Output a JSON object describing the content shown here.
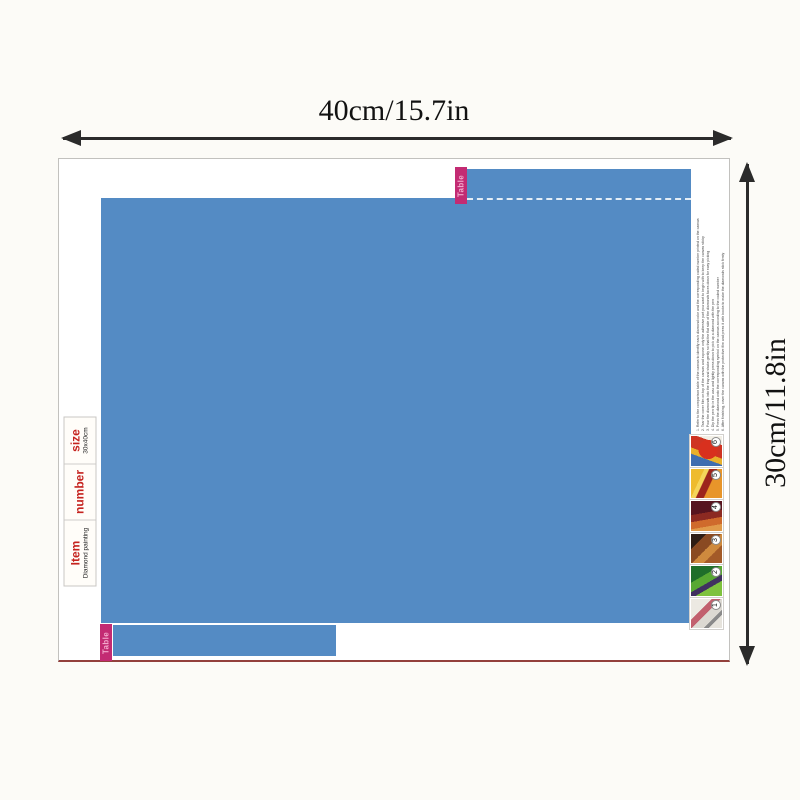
{
  "dimension_labels": {
    "width": "40cm/15.7in",
    "height": "30cm/11.8in"
  },
  "tabs": {
    "top_label": "Table",
    "bottom_label": "Table"
  },
  "info_table": {
    "columns": [
      {
        "label": "Item",
        "value": "Diamond painting"
      },
      {
        "label": "number",
        "value": ""
      },
      {
        "label": "size",
        "value": "30x40cm"
      }
    ]
  },
  "instructions": {
    "lines": [
      "1. Refer to the comparison table of the canvas to identify each diamond color and the corresponding coded number printed on the canvas",
      "2. Tear the cover film on top of the canvas and expose only the adhesive part you want to begin with to keep the canvas sticky",
      "3. Pour the diamonds into the tray and shake gently so that the flat side of the diamonds faces down for easy picking",
      "4. Dip the pen tip in the wax and lightly press down to pick up a diamond with the pen",
      "5. Press the diamond onto the corresponding symbol on the canvas according to the coded number",
      "6. After finishing, cover the canvas with the protective film and press it with books to make the diamonds stick firmly"
    ]
  },
  "photos": [
    {
      "number": "6"
    },
    {
      "number": "5"
    },
    {
      "number": "4"
    },
    {
      "number": "3"
    },
    {
      "number": "2"
    },
    {
      "number": "1"
    }
  ],
  "colors": {
    "artwork_blue": "#548bc4",
    "tab_pink": "#c32b73",
    "table_red": "#c5231f",
    "sheet_bottom_edge": "#93403c"
  }
}
